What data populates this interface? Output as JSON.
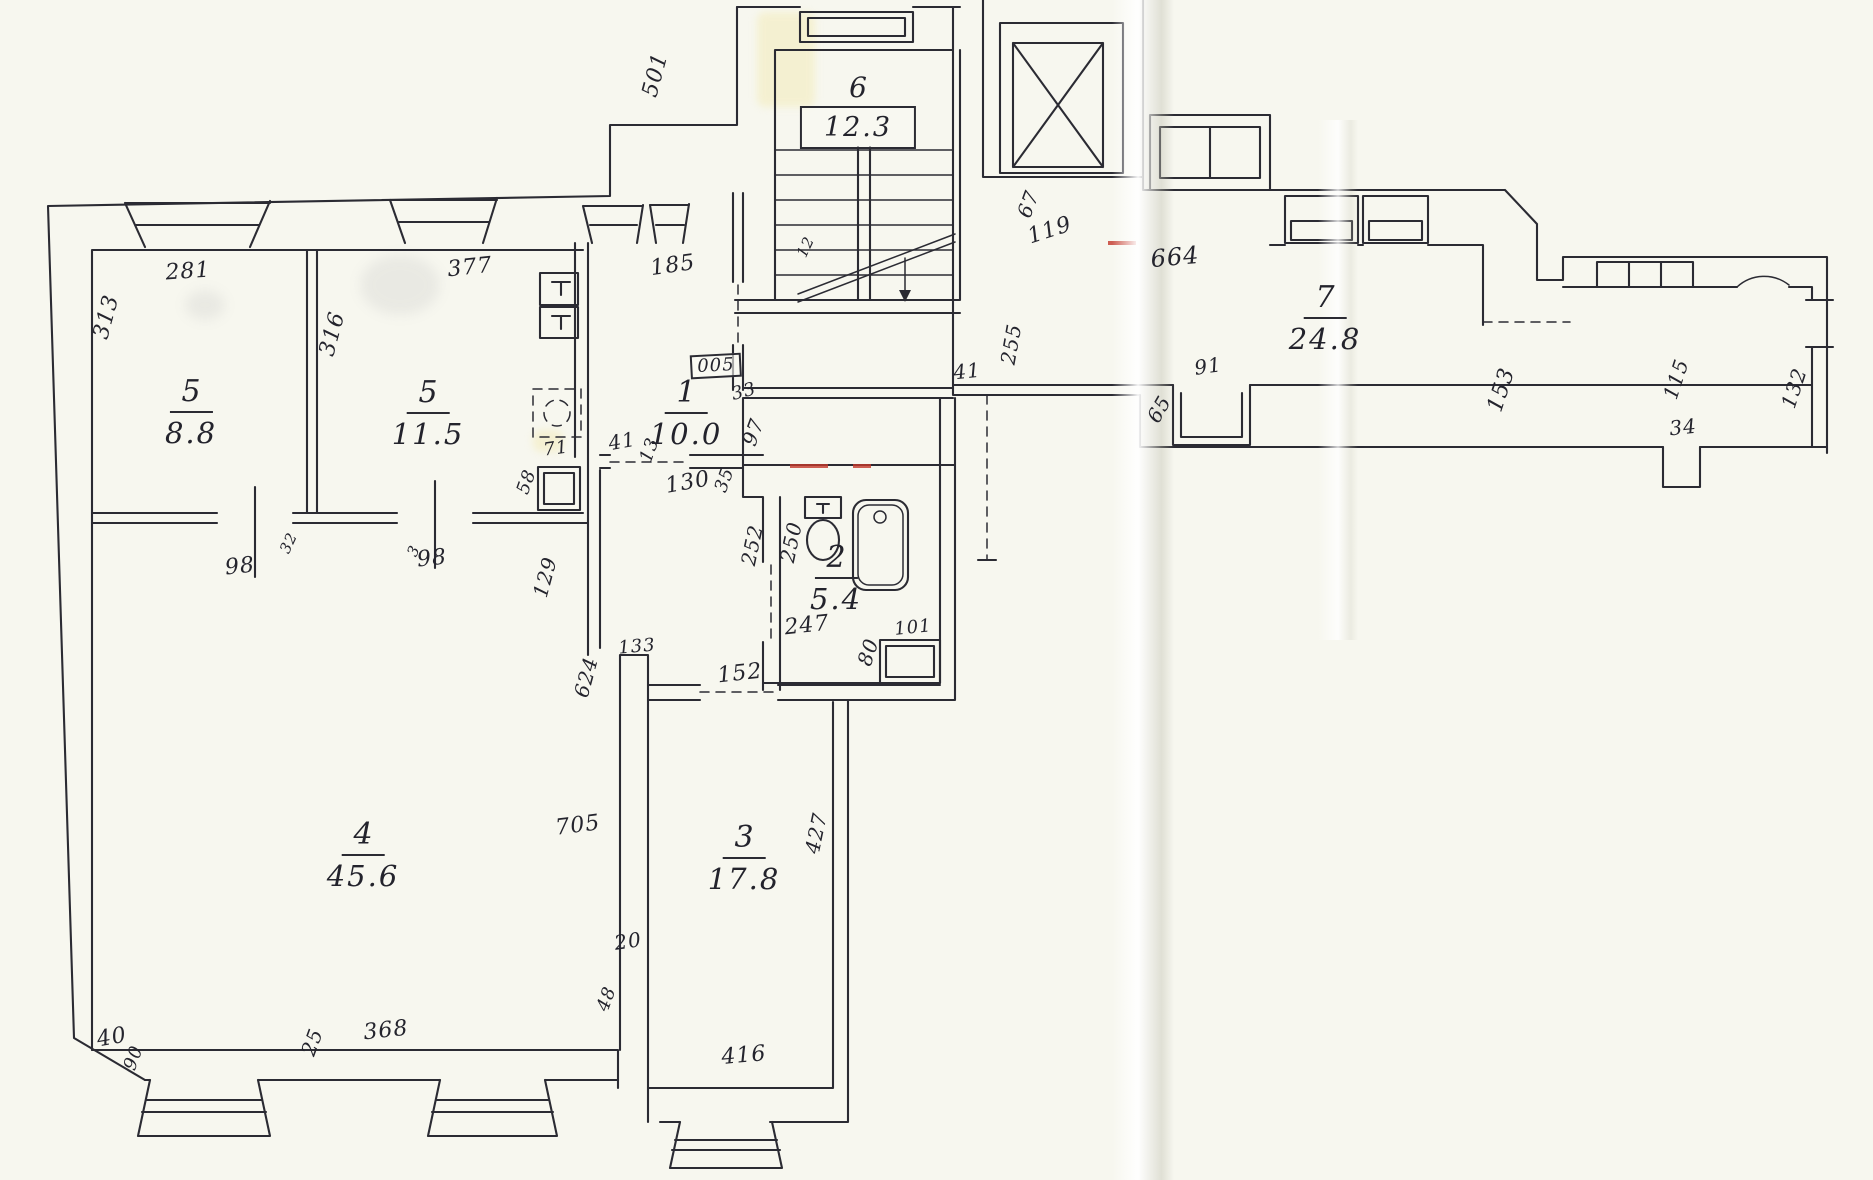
{
  "document": {
    "type": "scanned apartment floor plan",
    "style": "hand-drawn ink on folded paper"
  },
  "colors": {
    "paper": "#f7f7ef",
    "ink": "#2b2b33",
    "red_wall_mark": "#c4392c",
    "highlight_tint": "#f3ebb9"
  },
  "rooms": [
    {
      "number": "5",
      "area": "8.8",
      "x": 191,
      "y": 412
    },
    {
      "number": "5",
      "area": "11.5",
      "x": 428,
      "y": 413
    },
    {
      "number": "1",
      "area": "10.0",
      "x": 686,
      "y": 413
    },
    {
      "number": "2",
      "area": "5.4",
      "x": 836,
      "y": 578
    },
    {
      "number": "4",
      "area": "45.6",
      "x": 363,
      "y": 855
    },
    {
      "number": "3",
      "area": "17.8",
      "x": 744,
      "y": 858
    },
    {
      "number": "7",
      "area": "24.8",
      "x": 1325,
      "y": 318
    },
    {
      "number": "6",
      "area": "12.3",
      "x": 858,
      "y": 110,
      "boxed_area": true
    }
  ],
  "labels": [
    {
      "t": "281",
      "x": 188,
      "y": 272,
      "r": -4,
      "s": 22
    },
    {
      "t": "313",
      "x": 107,
      "y": 317,
      "r": -75,
      "s": 22
    },
    {
      "t": "377",
      "x": 470,
      "y": 268,
      "r": -6,
      "s": 22
    },
    {
      "t": "316",
      "x": 333,
      "y": 334,
      "r": -75,
      "s": 22
    },
    {
      "t": "185",
      "x": 673,
      "y": 266,
      "r": -8,
      "s": 22
    },
    {
      "t": "501",
      "x": 656,
      "y": 75,
      "r": -75,
      "s": 22
    },
    {
      "t": "12",
      "x": 806,
      "y": 247,
      "r": -65,
      "s": 15
    },
    {
      "t": "67",
      "x": 1028,
      "y": 204,
      "r": -70,
      "s": 20
    },
    {
      "t": "119",
      "x": 1050,
      "y": 231,
      "r": -18,
      "s": 22
    },
    {
      "t": "664",
      "x": 1175,
      "y": 257,
      "r": -5,
      "s": 24
    },
    {
      "t": "91",
      "x": 1208,
      "y": 366,
      "r": -8,
      "s": 20
    },
    {
      "t": "65",
      "x": 1159,
      "y": 409,
      "r": -60,
      "s": 20
    },
    {
      "t": "255",
      "x": 1011,
      "y": 344,
      "r": -80,
      "s": 20
    },
    {
      "t": "41",
      "x": 967,
      "y": 371,
      "r": -6,
      "s": 20
    },
    {
      "t": "153",
      "x": 1502,
      "y": 390,
      "r": -72,
      "s": 22
    },
    {
      "t": "115",
      "x": 1676,
      "y": 379,
      "r": -72,
      "s": 20
    },
    {
      "t": "34",
      "x": 1683,
      "y": 427,
      "r": -6,
      "s": 20
    },
    {
      "t": "132",
      "x": 1794,
      "y": 388,
      "r": -72,
      "s": 20
    },
    {
      "t": "005",
      "x": 716,
      "y": 366,
      "r": -3,
      "s": 18,
      "b": true
    },
    {
      "t": "33",
      "x": 744,
      "y": 392,
      "r": -15,
      "s": 18
    },
    {
      "t": "41",
      "x": 622,
      "y": 441,
      "r": -10,
      "s": 20
    },
    {
      "t": "13",
      "x": 650,
      "y": 450,
      "r": -70,
      "s": 18
    },
    {
      "t": "130",
      "x": 688,
      "y": 483,
      "r": -10,
      "s": 22
    },
    {
      "t": "35",
      "x": 725,
      "y": 480,
      "r": -70,
      "s": 18
    },
    {
      "t": "97",
      "x": 753,
      "y": 432,
      "r": -70,
      "s": 20
    },
    {
      "t": "71",
      "x": 556,
      "y": 449,
      "r": -8,
      "s": 18
    },
    {
      "t": "58",
      "x": 527,
      "y": 482,
      "r": -70,
      "s": 18
    },
    {
      "t": "252",
      "x": 752,
      "y": 545,
      "r": -78,
      "s": 20
    },
    {
      "t": "250",
      "x": 791,
      "y": 542,
      "r": -78,
      "s": 20
    },
    {
      "t": "247",
      "x": 807,
      "y": 626,
      "r": -6,
      "s": 22
    },
    {
      "t": "80",
      "x": 868,
      "y": 652,
      "r": -72,
      "s": 20
    },
    {
      "t": "101",
      "x": 913,
      "y": 628,
      "r": -6,
      "s": 18
    },
    {
      "t": "152",
      "x": 740,
      "y": 674,
      "r": -6,
      "s": 22
    },
    {
      "t": "98",
      "x": 240,
      "y": 567,
      "r": -6,
      "s": 22
    },
    {
      "t": "32",
      "x": 289,
      "y": 543,
      "r": -65,
      "s": 15
    },
    {
      "t": "98",
      "x": 432,
      "y": 559,
      "r": -6,
      "s": 22
    },
    {
      "t": "3",
      "x": 414,
      "y": 551,
      "r": -65,
      "s": 15
    },
    {
      "t": "129",
      "x": 545,
      "y": 577,
      "r": -75,
      "s": 20
    },
    {
      "t": "624",
      "x": 586,
      "y": 677,
      "r": -75,
      "s": 20
    },
    {
      "t": "133",
      "x": 637,
      "y": 647,
      "r": -5,
      "s": 18
    },
    {
      "t": "705",
      "x": 578,
      "y": 826,
      "r": -7,
      "s": 22
    },
    {
      "t": "20",
      "x": 628,
      "y": 941,
      "r": -8,
      "s": 20
    },
    {
      "t": "427",
      "x": 816,
      "y": 833,
      "r": -78,
      "s": 20
    },
    {
      "t": "40",
      "x": 112,
      "y": 1038,
      "r": -10,
      "s": 22
    },
    {
      "t": "90",
      "x": 134,
      "y": 1058,
      "r": -70,
      "s": 18
    },
    {
      "t": "25",
      "x": 312,
      "y": 1042,
      "r": -70,
      "s": 20
    },
    {
      "t": "368",
      "x": 386,
      "y": 1031,
      "r": -6,
      "s": 22
    },
    {
      "t": "48",
      "x": 607,
      "y": 999,
      "r": -70,
      "s": 18
    },
    {
      "t": "416",
      "x": 744,
      "y": 1056,
      "r": -5,
      "s": 22
    }
  ],
  "fixtures": [
    "stairs",
    "elevator",
    "bathtub",
    "toilet",
    "wash-basin",
    "kitchen-sink",
    "stove",
    "closet",
    "windows",
    "door-swing-arc"
  ]
}
